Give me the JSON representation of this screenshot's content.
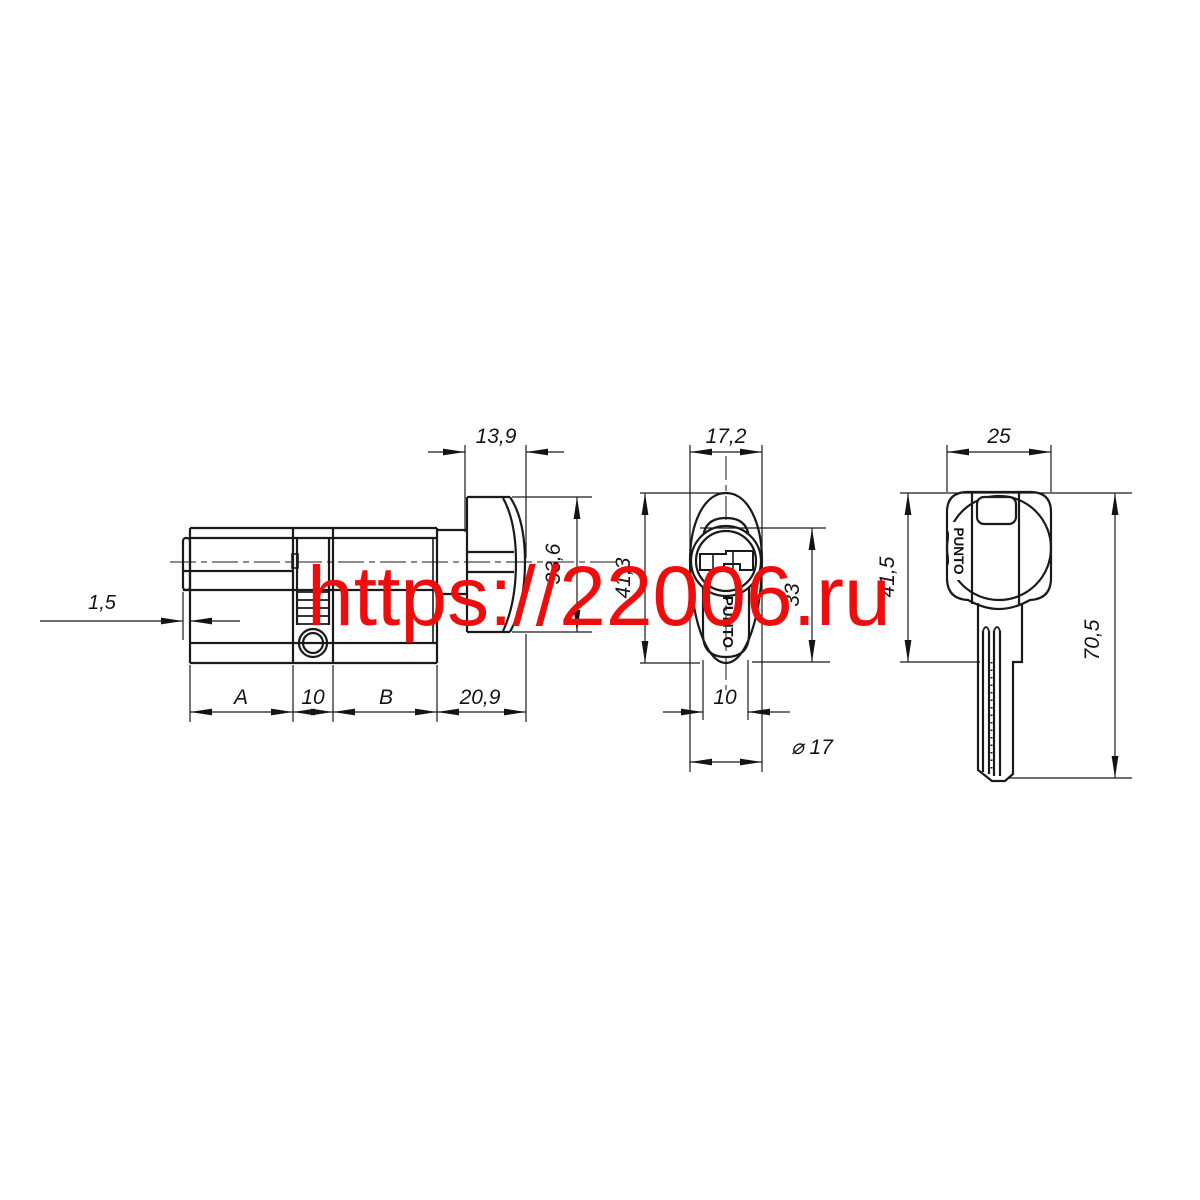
{
  "watermark": {
    "text": "https://22006.ru",
    "color": "#ee0d0d"
  },
  "brand_label": "PUNTO",
  "side_view": {
    "face_thickness": "1,5",
    "seg_a": "A",
    "seg_mid": "10",
    "seg_b": "B",
    "seg_knob": "20,9",
    "knob_width": "13,9",
    "knob_height": "33,6"
  },
  "front_view": {
    "width": "17,2",
    "height": "41,3",
    "body_height": "33",
    "slot_width": "10",
    "plug_diameter": "⌀ 17"
  },
  "key_view": {
    "head_width": "25",
    "head_length": "41,5",
    "total_length": "70,5"
  }
}
